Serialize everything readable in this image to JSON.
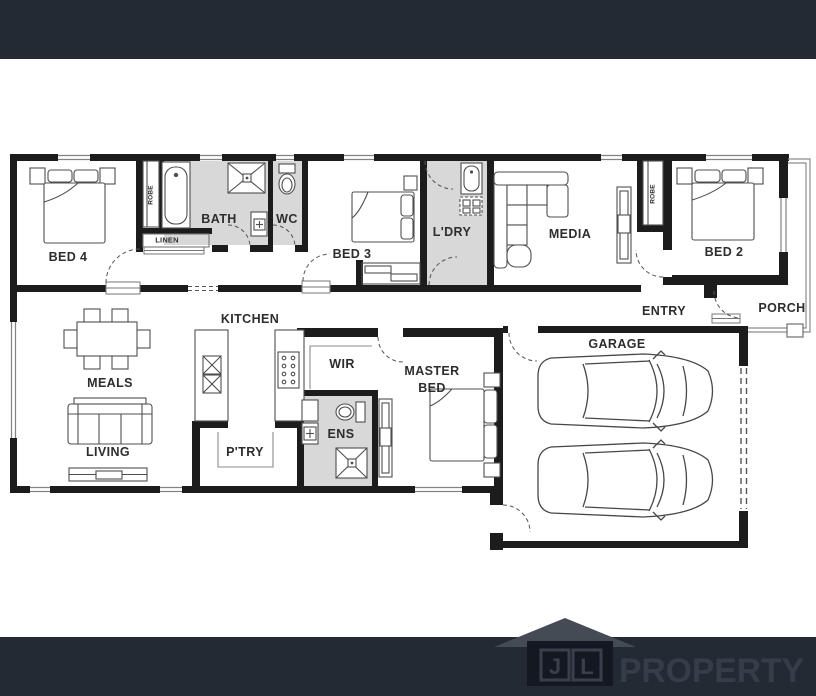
{
  "branding": {
    "logo_letter1": "J",
    "logo_letter2": "L",
    "logo_name": "PROPERTY"
  },
  "rooms": {
    "bed4": "BED 4",
    "bath": "BATH",
    "wc": "WC",
    "bed3": "BED 3",
    "ldry": "L'DRY",
    "media": "MEDIA",
    "bed2": "BED 2",
    "porch": "PORCH",
    "entry": "ENTRY",
    "garage": "GARAGE",
    "kitchen": "KITCHEN",
    "meals": "MEALS",
    "wir": "WIR",
    "master_line1": "MASTER",
    "master_line2": "BED",
    "ens": "ENS",
    "ptry": "P'TRY",
    "living": "LIVING",
    "linen": "LINEN",
    "robe_bed4": "ROBE",
    "robe_bed2": "ROBE"
  },
  "colors": {
    "banner": "#242a33",
    "wall": "#1c1c1c",
    "wet_area": "#d8d8d8",
    "furniture_line": "#4f4f4f",
    "logo_text": "#363d49"
  }
}
